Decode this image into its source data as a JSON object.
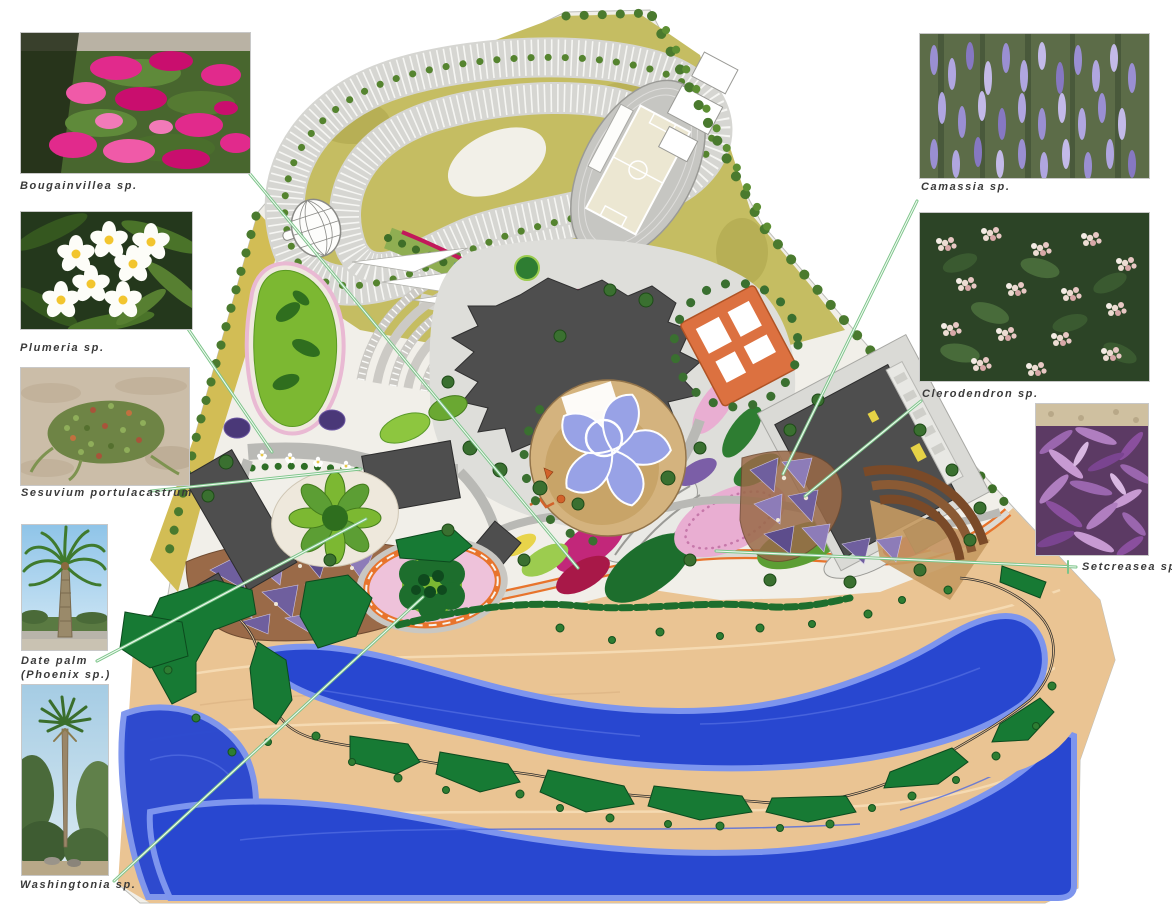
{
  "document": {
    "type": "landscape-planting-master-plan",
    "background_color": "#ffffff"
  },
  "callouts": {
    "left": [
      {
        "id": "bougainvillea",
        "label": "Bougainvillea sp."
      },
      {
        "id": "plumeria",
        "label": "Plumeria sp."
      },
      {
        "id": "sesuvium",
        "label": "Sesuvium portulacastrum"
      },
      {
        "id": "date-palm",
        "label_line1": "Date palm",
        "label_line2": "(Phoenix sp.)"
      },
      {
        "id": "washingtonia",
        "label": "Washingtonia sp."
      }
    ],
    "right": [
      {
        "id": "camassia",
        "label": "Camassia sp."
      },
      {
        "id": "clerodendron",
        "label": "Clerodendron sp."
      },
      {
        "id": "setcreasea",
        "label": "Setcreasea sp."
      }
    ]
  },
  "plan": {
    "features": [
      "site-boundary",
      "meadow",
      "looping-parking-lot",
      "amphitheater-parking",
      "running-track-stadium",
      "sports-courts",
      "palm-tree-rows",
      "lattice-dome",
      "shade-sails",
      "central-building-complex",
      "flower-water-feature-plaza",
      "courtyard-building",
      "exhibition-building",
      "mosaic-paving",
      "teardrop-lawn",
      "petal-garden",
      "flower-stamp-walk",
      "ring-flower-garden",
      "orange-promenade",
      "swirl-planting-beds",
      "beach",
      "lake",
      "shore-trail",
      "berm-islands",
      "shrubs"
    ],
    "colors": {
      "meadow": "#c5bd62",
      "parking": "#d6d6d2",
      "building": "#4e4e4e",
      "courtyard_building": "#dc7140",
      "water_feature": "#98a2e6",
      "plaza_tan": "#d4b37e",
      "beach": "#eac493",
      "lake": "#2847d0",
      "berm_green": "#177a34",
      "pink_bed": "#e6a8cc",
      "magenta_bed": "#c2277a",
      "orange_road": "#e8742c",
      "mosaic_purple": "#6f5f9e",
      "connector_line": "#7cc489"
    }
  }
}
